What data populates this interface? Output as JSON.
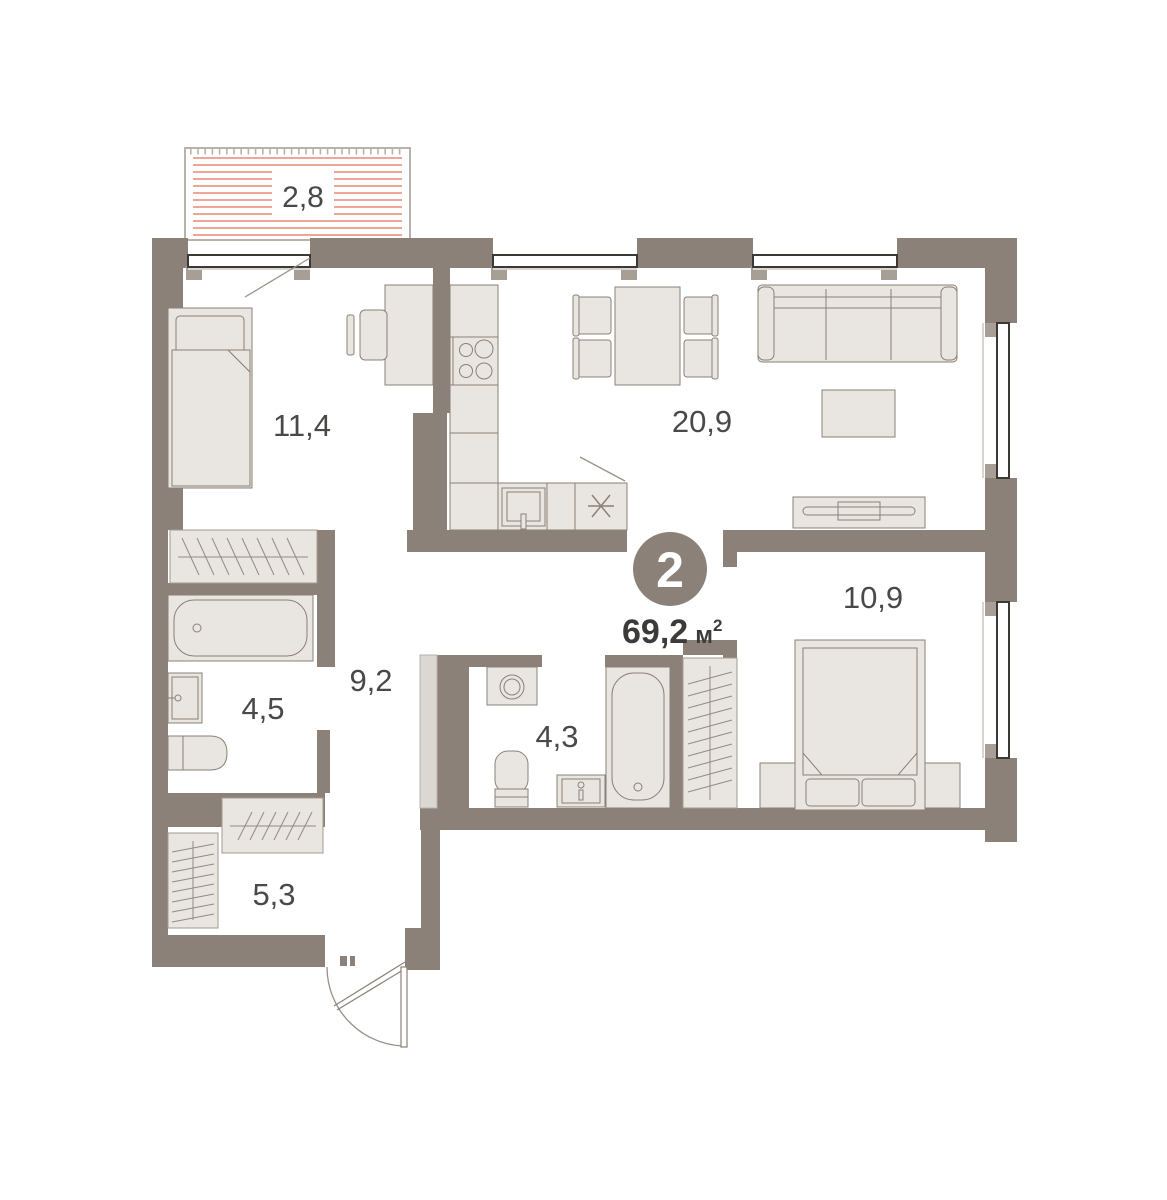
{
  "plan": {
    "badge": {
      "rooms_count": "2"
    },
    "total_area": {
      "value": "69,2",
      "unit": "м",
      "unit_sup": "2"
    },
    "labels": {
      "balcony": "2,8",
      "bedroom1": "11,4",
      "living": "20,9",
      "bedroom2": "10,9",
      "hallway": "9,2",
      "bathroom1": "4,5",
      "bathroom2": "4,3",
      "storage": "5,3"
    },
    "colors": {
      "wall": "#8b8178",
      "furniture_fill": "#e9e5e1",
      "furniture_stroke": "#8b8178",
      "balcony_stripe": "#e4705c",
      "balcony_border": "#b9b2ab",
      "window_stroke": "#3b3935",
      "text": "#4a4947",
      "area_text": "#3c3b39",
      "badge_fill": "#8b8178",
      "badge_text": "#ffffff"
    }
  }
}
